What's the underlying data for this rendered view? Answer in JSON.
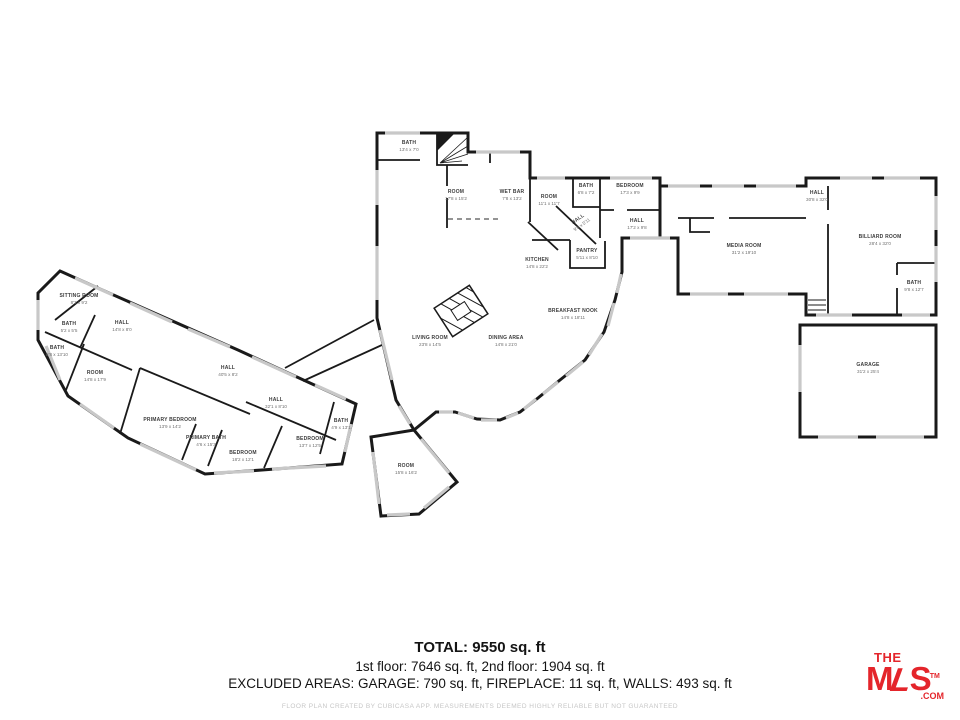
{
  "floorplan": {
    "rooms": [
      {
        "name": "BATH",
        "dims": "13'4 x 7'0",
        "x": 409,
        "y": 146,
        "rot": 0
      },
      {
        "name": "ROOM",
        "dims": "17'8 x 15'2",
        "x": 456,
        "y": 195,
        "rot": 0
      },
      {
        "name": "WET BAR",
        "dims": "7'8 x 13'2",
        "x": 512,
        "y": 195,
        "rot": 0
      },
      {
        "name": "ROOM",
        "dims": "11'1 x 11'7",
        "x": 549,
        "y": 200,
        "rot": 0
      },
      {
        "name": "BATH",
        "dims": "6'8 x 7'2",
        "x": 586,
        "y": 189,
        "rot": 0
      },
      {
        "name": "BEDROOM",
        "dims": "17'3 x 9'9",
        "x": 630,
        "y": 189,
        "rot": 0
      },
      {
        "name": "HALL",
        "dims": "9'8 x 5'11",
        "x": 580,
        "y": 222,
        "rot": -35
      },
      {
        "name": "HALL",
        "dims": "17'2 x 9'8",
        "x": 637,
        "y": 224,
        "rot": 0
      },
      {
        "name": "PANTRY",
        "dims": "5'11 x 8'10",
        "x": 587,
        "y": 254,
        "rot": 0
      },
      {
        "name": "KITCHEN",
        "dims": "14'8 x 22'2",
        "x": 537,
        "y": 263,
        "rot": 0
      },
      {
        "name": "BREAKFAST NOOK",
        "dims": "14'8 x 18'11",
        "x": 573,
        "y": 314,
        "rot": 0
      },
      {
        "name": "LIVING ROOM",
        "dims": "23'8 x 14'5",
        "x": 430,
        "y": 341,
        "rot": 0
      },
      {
        "name": "DINING AREA",
        "dims": "14'8 x 21'0",
        "x": 506,
        "y": 341,
        "rot": 0
      },
      {
        "name": "HALL",
        "dims": "30'8 x 32'0",
        "x": 817,
        "y": 196,
        "rot": 0
      },
      {
        "name": "MEDIA ROOM",
        "dims": "31'2 x 19'10",
        "x": 744,
        "y": 249,
        "rot": 0
      },
      {
        "name": "BILLIARD ROOM",
        "dims": "28'4 x 32'0",
        "x": 880,
        "y": 240,
        "rot": 0
      },
      {
        "name": "BATH",
        "dims": "9'8 x 12'7",
        "x": 914,
        "y": 286,
        "rot": 0
      },
      {
        "name": "GARAGE",
        "dims": "31'2 x 25'4",
        "x": 868,
        "y": 368,
        "rot": 0
      },
      {
        "name": "SITTING ROOM",
        "dims": "8'3 x 9'2",
        "x": 79,
        "y": 299,
        "rot": 0
      },
      {
        "name": "BATH",
        "dims": "5'2 x 5'5",
        "x": 69,
        "y": 327,
        "rot": 0
      },
      {
        "name": "HALL",
        "dims": "14'8 x 8'0",
        "x": 122,
        "y": 326,
        "rot": 0
      },
      {
        "name": "BATH",
        "dims": "8'8 x 13'10",
        "x": 57,
        "y": 351,
        "rot": 0
      },
      {
        "name": "ROOM",
        "dims": "14'8 x 17'9",
        "x": 95,
        "y": 376,
        "rot": 0
      },
      {
        "name": "HALL",
        "dims": "40'5 x 8'2",
        "x": 228,
        "y": 371,
        "rot": 0
      },
      {
        "name": "PRIMARY BEDROOM",
        "dims": "13'9 x 14'2",
        "x": 170,
        "y": 423,
        "rot": 0
      },
      {
        "name": "PRIMARY BATH",
        "dims": "4'6 x 15'3",
        "x": 206,
        "y": 441,
        "rot": 0
      },
      {
        "name": "HALL",
        "dims": "32'1 x 8'10",
        "x": 276,
        "y": 403,
        "rot": 0
      },
      {
        "name": "BEDROOM",
        "dims": "18'2 x 12'1",
        "x": 243,
        "y": 456,
        "rot": 0
      },
      {
        "name": "BEDROOM",
        "dims": "13'7 x 12'5",
        "x": 310,
        "y": 442,
        "rot": 0
      },
      {
        "name": "BATH",
        "dims": "4'9 x 13'1",
        "x": 341,
        "y": 424,
        "rot": 0
      },
      {
        "name": "ROOM",
        "dims": "15'8 x 16'2",
        "x": 406,
        "y": 469,
        "rot": 0
      }
    ]
  },
  "summary": {
    "total": "TOTAL: 9550 sq. ft",
    "floors": "1st floor: 7646 sq. ft, 2nd floor: 1904 sq. ft",
    "excluded": "EXCLUDED AREAS: GARAGE: 790 sq. ft, FIREPLACE: 11 sq. ft, WALLS: 493 sq. ft"
  },
  "footer": {
    "disclaimer": "FLOOR PLAN CREATED BY CUBICASA APP. MEASUREMENTS DEEMED HIGHLY RELIABLE BUT NOT GUARANTEED"
  },
  "logo": {
    "the": "THE",
    "m": "M",
    "l": "L",
    "s": "S",
    "tm": "TM",
    "com": ".COM",
    "color": "#e4252b"
  }
}
